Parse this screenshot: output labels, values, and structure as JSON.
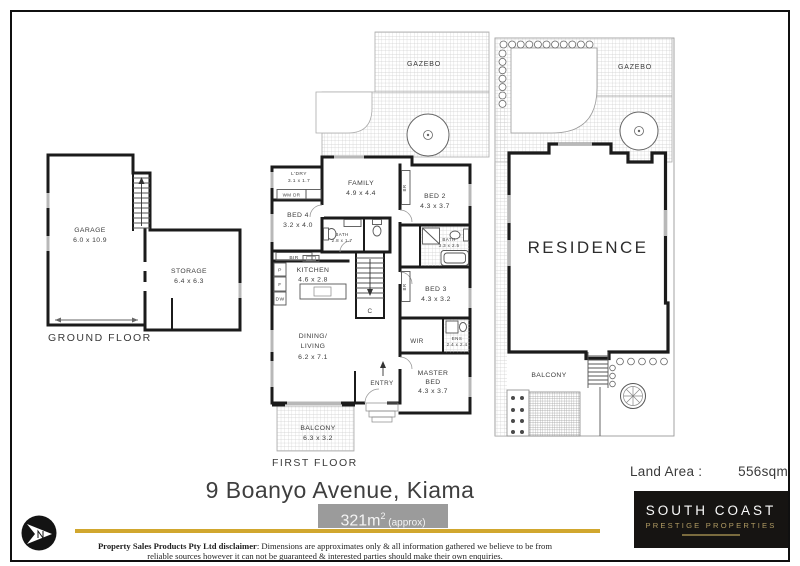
{
  "ground_floor": {
    "label": "GROUND FLOOR",
    "garage": {
      "name": "GARAGE",
      "dims": "6.0 x 10.9"
    },
    "storage": {
      "name": "STORAGE",
      "dims": "6.4 x 6.3"
    }
  },
  "first_floor": {
    "label": "FIRST FLOOR",
    "gazebo": {
      "name": "GAZEBO"
    },
    "family": {
      "name": "FAMILY",
      "dims": "4.9 x 4.4"
    },
    "ldry": {
      "name": "L'DRY",
      "dims": "3.1 x 1.7",
      "appliances": "WM DR"
    },
    "bed4": {
      "name": "BED 4",
      "dims": "3.2 x 4.0"
    },
    "bed2": {
      "name": "BED 2",
      "dims": "4.3 x 3.7"
    },
    "bath": {
      "name": "BATH",
      "dims": "2.8 x 1.7"
    },
    "bath2": {
      "name": "BATH",
      "dims": "3.3 x 2.5"
    },
    "kitchen": {
      "name": "KITCHEN",
      "dims": "4.6 x 2.8",
      "pantry": "P",
      "fridge": "F",
      "dishwasher": "DW"
    },
    "bed3": {
      "name": "BED 3",
      "dims": "4.3 x 3.2"
    },
    "wir": {
      "name": "WIR"
    },
    "ens": {
      "name": "ENS",
      "dims": "2.4 x 2.4"
    },
    "dining_living": {
      "name_line1": "DINING/",
      "name_line2": "LIVING",
      "dims": "6.2 x 7.1"
    },
    "master_bed": {
      "name_line1": "MASTER",
      "name_line2": "BED",
      "dims": "4.3 x 3.7"
    },
    "entry": {
      "name": "ENTRY"
    },
    "balcony": {
      "name": "BALCONY",
      "dims": "6.3 x 3.2"
    },
    "robe1": "BR",
    "robe2": "BR",
    "built_in_robe": "BIR",
    "cupboard": "C"
  },
  "site_plan": {
    "gazebo": {
      "name": "GAZEBO"
    },
    "residence": {
      "name": "RESIDENCE"
    },
    "balcony": {
      "name": "BALCONY"
    },
    "land_area_label": "Land Area :",
    "land_area_value": "556sqm"
  },
  "footer": {
    "address": "9 Boanyo Avenue, Kiama",
    "floor_area": "321m",
    "floor_area_sup": "2",
    "floor_area_suffix": " (approx)",
    "disclaimer_bold": "Property Sales Products Pty Ltd disclaimer",
    "disclaimer_text": ": Dimensions are approximates only & all information gathered we believe to be from reliable sources however it can not be guaranteed & interested parties should make their own enquiries."
  },
  "brand": {
    "name_line1": "SOUTH COAST",
    "name_line2": "PRESTIGE PROPERTIES"
  },
  "colors": {
    "accent_gold": "#d1a72e",
    "area_bar": "#9b9b9b",
    "logo_bg": "#161412",
    "logo_gold": "#b09b63",
    "wall": "#1b1b1b"
  }
}
